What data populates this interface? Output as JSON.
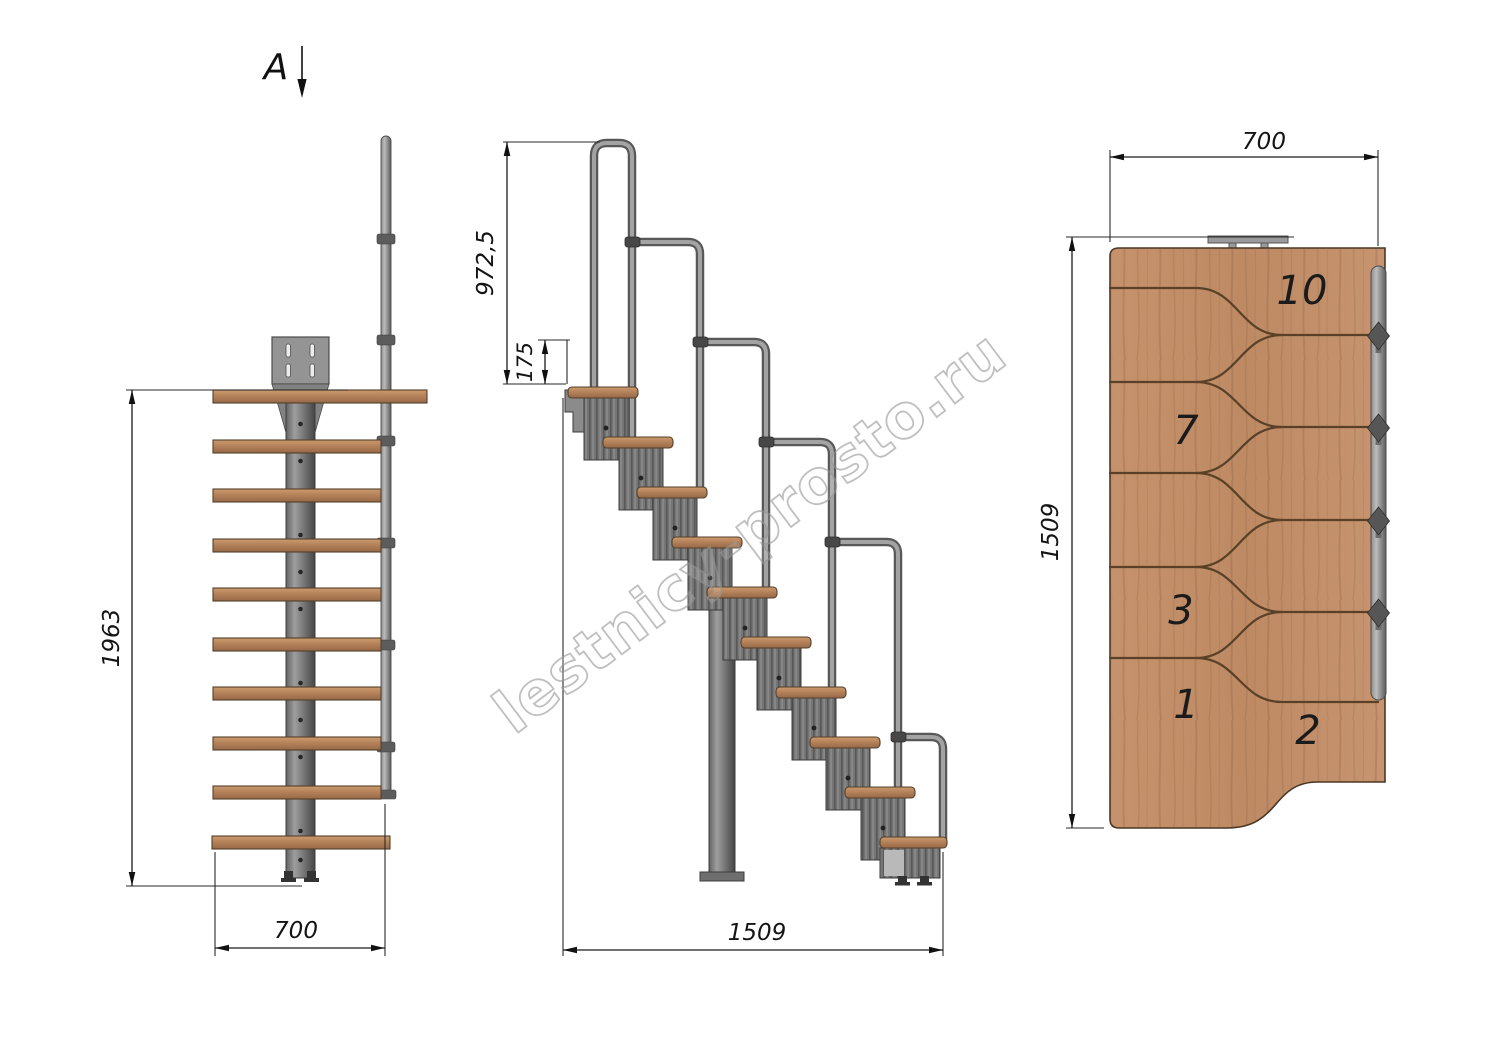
{
  "drawing": {
    "watermark": "lestnicy-prosto.ru",
    "section_marker": {
      "label": "A"
    },
    "front_view": {
      "height_dim": "1963",
      "width_dim": "700"
    },
    "side_view": {
      "handrail_height_dim": "972,5",
      "rail_offset_dim": "175",
      "length_dim": "1509"
    },
    "top_view": {
      "width_dim": "700",
      "length_dim": "1509",
      "tread_numbers": [
        "10",
        "7",
        "3",
        "2",
        "1"
      ]
    },
    "colors": {
      "wood": "#c08d6a",
      "wood_outline": "#54402c",
      "metal_light": "#9a9a9a",
      "metal_dark": "#4f4f4f",
      "dim_line": "#1a1a1a",
      "watermark_gray": "#999999"
    }
  }
}
